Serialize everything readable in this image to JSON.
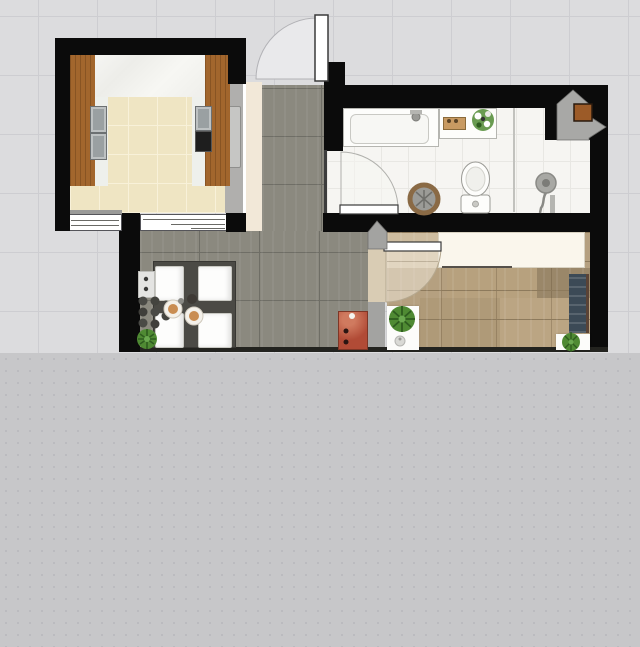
{
  "app": {
    "view": "apartment-floor-plan-top-view",
    "visible_text": "none"
  },
  "palette": {
    "bg_top": "#dcdcde",
    "bg_grid": "#cdcdd1",
    "bg_bottom": "#c7c7c9",
    "bg_bottom_dot": "#b8b8bc",
    "wall": "#0b0b0b",
    "wall_gray": "#a3a3a1",
    "kitchen_tile": "#efe5c3",
    "kitchen_tile_seam": "#f8f1d9",
    "cabinet_wood": "#a2662d",
    "cabinet_wood_dark": "#7e4c20",
    "appliance_gray": "#9aa0a2",
    "appliance_dark": "#1e1e1e",
    "white_gap": "#eef0ec",
    "sill_gray": "#9a9a98",
    "corridor_tile": "#8b897f",
    "corridor_seam": "#6f6e66",
    "cream_strip": "#f2e8d8",
    "slider_gray": "#b0afad",
    "slider_panel": "#c6c6c4",
    "bath_tile": "#f6f5f2",
    "bath_seam": "#e8e7e3",
    "fixture_white": "#fdfdfb",
    "fixture_stroke": "#b5b5b0",
    "basket_rim": "#8a6a45",
    "basket_fill": "#9b9b97",
    "shower_gray": "#a8a8a4",
    "corner_orange": "#9c5b28",
    "wood_floor": "#b5a080",
    "wood_seam": "#8d7a5c",
    "wardrobe_cream": "#faf6ec",
    "wardrobe_border": "#d8d2c2",
    "navy_unit": "#3c4a56",
    "navy_trim": "#5a4336",
    "mat_white": "#fcfcfa",
    "plant_green": "#4f8a33",
    "plant_dark": "#2e5c1f",
    "red_cabinet": "#b14b36",
    "red_cabinet_hi": "#d07a5f",
    "table_dark": "#4b4a45",
    "chair_white": "#fdfdfc",
    "chair_border": "#c9c9c3",
    "door_leaf": "#ffffff",
    "door_stroke": "#3a3a3a",
    "swing_fill": "#e9e9eb",
    "swing_stroke": "#b2b2b6",
    "threshold_tan": "#d9ccb4",
    "plate": "#f4f1ea",
    "food_tan": "#c98d52",
    "bowl_dark": "#3e3a35"
  },
  "scene": {
    "rooms": [
      {
        "name": "kitchen",
        "objects": [
          "counter-left-wood",
          "counter-right-wood",
          "sink-appliance",
          "stove-appliance",
          "marble-worktop",
          "window-left",
          "window-right",
          "sliding-door-panel"
        ]
      },
      {
        "name": "hallway",
        "objects": [
          "entry-door",
          "shoe-cabinet-red"
        ]
      },
      {
        "name": "bathroom",
        "objects": [
          "bathtub",
          "vanity-shelf",
          "wooden-tray",
          "flower-bouquet",
          "toilet",
          "laundry-basket",
          "shower-glass-panel",
          "shower-head",
          "corner-duct",
          "duct-vent-square",
          "bathroom-door"
        ]
      },
      {
        "name": "dining-area",
        "objects": [
          "dining-table",
          "chair-x4",
          "plates",
          "sideboard-white",
          "bottle-rack",
          "potted-plant"
        ]
      },
      {
        "name": "bedroom",
        "objects": [
          "wardrobe-cream",
          "tall-cabinet-navy",
          "rug-with-plant-left",
          "vase-small",
          "rug-with-plant-right",
          "bedroom-door"
        ]
      }
    ]
  }
}
